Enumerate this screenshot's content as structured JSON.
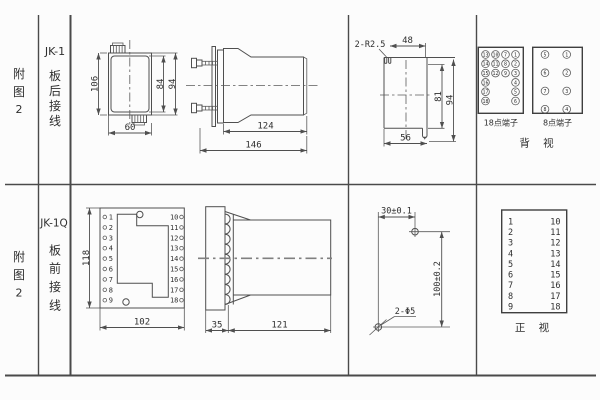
{
  "header_top": {
    "figure": [
      "附",
      "图",
      "2"
    ],
    "model": "JK-1",
    "wiring": [
      "板",
      "后",
      "接",
      "线"
    ]
  },
  "header_bottom": {
    "figure": [
      "附",
      "图",
      "2"
    ],
    "model": "JK-1Q",
    "wiring": [
      "板",
      "前",
      "接",
      "线"
    ]
  },
  "rear_case": {
    "h_outer": "106",
    "h_inner": "84",
    "h_mid": "94",
    "width": "60"
  },
  "rear_side": {
    "body": "124",
    "total": "146"
  },
  "cutout": {
    "slot_label": "2-R2.5",
    "top": "48",
    "inner": "81",
    "outer": "94",
    "bottom": "56"
  },
  "rear_terminals": {
    "t18": {
      "title": "18点端子",
      "col1": [
        "13",
        "14",
        "15",
        "16",
        "17",
        "18"
      ],
      "col2": [
        "10",
        "11",
        "12"
      ],
      "col3": [
        "7",
        "8",
        "9"
      ],
      "col4": [
        "1",
        "2",
        "3",
        "4",
        "5",
        "6"
      ]
    },
    "t8": {
      "title": "8点端子",
      "left": [
        "5",
        "6",
        "7",
        "8"
      ],
      "right": [
        "1",
        "2",
        "3",
        "4"
      ]
    },
    "view_label": "背 视"
  },
  "front_view": {
    "height": "118",
    "width": "102",
    "left": [
      "1",
      "2",
      "3",
      "4",
      "5",
      "6",
      "7",
      "8",
      "9"
    ],
    "right": [
      "10",
      "11",
      "12",
      "13",
      "14",
      "15",
      "16",
      "17",
      "18"
    ]
  },
  "front_side": {
    "plate": "35",
    "body": "121"
  },
  "drill": {
    "horizontal": "30±0.1",
    "vertical": "100±0.2",
    "holes": "2-Φ5"
  },
  "front_terminals": {
    "left": [
      "1",
      "2",
      "3",
      "4",
      "5",
      "6",
      "7",
      "8",
      "9"
    ],
    "right": [
      "10",
      "11",
      "12",
      "13",
      "14",
      "15",
      "16",
      "17",
      "18"
    ],
    "view_label": "正 视"
  },
  "colors": {
    "line": "#4f4f4f",
    "text": "#2e2e2e",
    "background": "#fcfcfc"
  }
}
